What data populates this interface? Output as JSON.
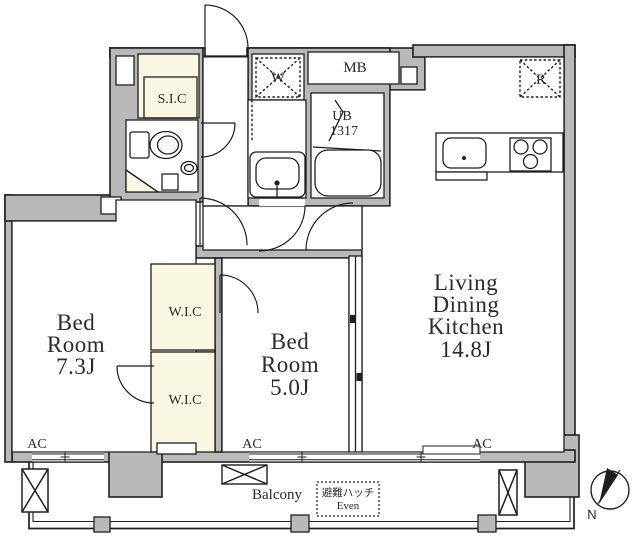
{
  "floorplan": {
    "colors": {
      "wall": "#b9b9b9",
      "closet": "#f9f6e1",
      "line": "#1f1f1f"
    },
    "rooms": {
      "bedroom1": {
        "line1": "Bed",
        "line2": "Room",
        "line3": "7.3J"
      },
      "bedroom2": {
        "line1": "Bed",
        "line2": "Room",
        "line3": "5.0J"
      },
      "ldk": {
        "line1": "Living",
        "line2": "Dining",
        "line3": "Kitchen",
        "line4": "14.8J"
      },
      "sic": "S.I.C",
      "wic_upper": "W.I.C",
      "wic_lower": "W.I.C",
      "ub": {
        "line1": "UB",
        "line2": "1317"
      },
      "mb": "MB",
      "washer": "W",
      "refrigerator": "R",
      "balcony": "Balcony",
      "ac1": "AC",
      "ac2": "AC",
      "ac3": "AC",
      "hatch": {
        "line1": "避難ハッチ",
        "line2": "Even"
      },
      "compass_north": "N"
    }
  }
}
